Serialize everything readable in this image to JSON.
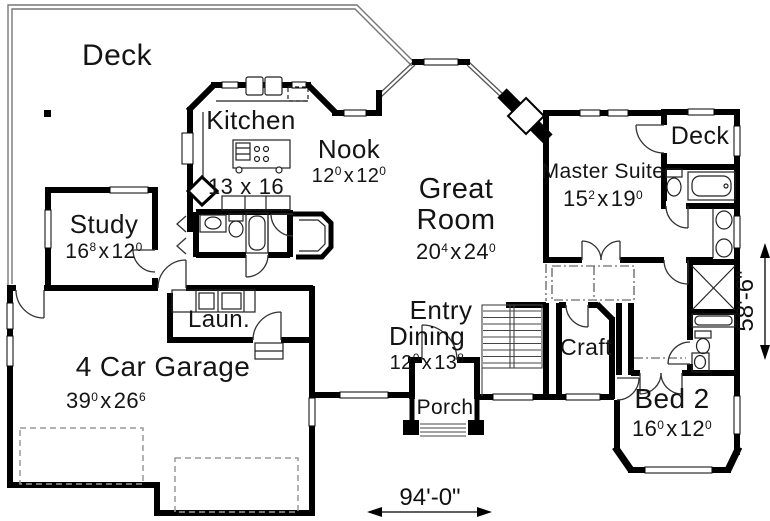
{
  "plan": {
    "sep": "x",
    "rooms": {
      "deck_main": {
        "label": "Deck"
      },
      "kitchen": {
        "label": "Kitchen",
        "dim": {
          "a": "13",
          "as": "",
          "b": "16",
          "bs": ""
        }
      },
      "nook": {
        "label": "Nook",
        "dim": {
          "a": "12",
          "as": "0",
          "b": "12",
          "bs": "0"
        }
      },
      "great_room": {
        "label1": "Great",
        "label2": "Room",
        "dim": {
          "a": "20",
          "as": "4",
          "b": "24",
          "bs": "0"
        }
      },
      "master": {
        "label": "Master Suite",
        "dim": {
          "a": "15",
          "as": "2",
          "b": "19",
          "bs": "0"
        }
      },
      "deck_small": {
        "label": "Deck"
      },
      "study": {
        "label": "Study",
        "dim": {
          "a": "16",
          "as": "8",
          "b": "12",
          "bs": "0"
        }
      },
      "laundry": {
        "label": "Laun."
      },
      "garage": {
        "label": "4 Car Garage",
        "dim": {
          "a": "39",
          "as": "0",
          "b": "26",
          "bs": "6"
        }
      },
      "dining": {
        "label": "Dining",
        "dim": {
          "a": "12",
          "as": "0",
          "b": "13",
          "bs": "8"
        }
      },
      "entry": {
        "label": "Entry"
      },
      "porch": {
        "label": "Porch"
      },
      "craft": {
        "label": "Craft"
      },
      "bed2": {
        "label": "Bed 2",
        "dim": {
          "a": "16",
          "as": "0",
          "b": "12",
          "bs": "0"
        }
      }
    },
    "dims": {
      "width": "94'-0\"",
      "height": "58'-6\""
    }
  }
}
